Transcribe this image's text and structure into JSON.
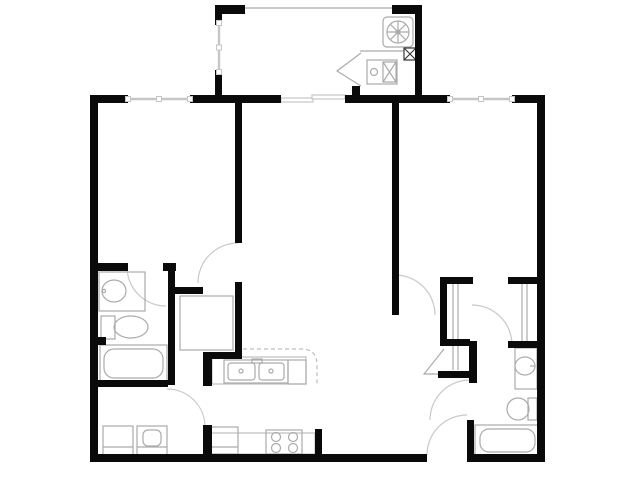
{
  "plan": {
    "canvas": {
      "width": 640,
      "height": 480,
      "background": "#ffffff"
    },
    "colors": {
      "wall": "#0a0a0a",
      "fixture": "#ababab",
      "counter": "#bdbdbd",
      "door_arc": "#c9c9c9",
      "window": "#c6c6c6",
      "dark_detail": "#3a3a3a"
    },
    "walls": [
      {
        "name": "wall-exterior-left",
        "r": [
          90,
          95,
          8,
          367
        ]
      },
      {
        "name": "wall-top-bed1-left",
        "r": [
          90,
          95,
          38,
          8
        ]
      },
      {
        "name": "wall-top-mid",
        "r": [
          190,
          95,
          91,
          8
        ]
      },
      {
        "name": "wall-top-living-right",
        "r": [
          345,
          95,
          105,
          8
        ]
      },
      {
        "name": "wall-top-right-corner",
        "r": [
          512,
          95,
          33,
          8
        ]
      },
      {
        "name": "wall-exterior-right",
        "r": [
          537,
          95,
          8,
          367
        ]
      },
      {
        "name": "wall-bottom-left",
        "r": [
          90,
          454,
          337,
          8
        ]
      },
      {
        "name": "wall-bottom-right",
        "r": [
          467,
          454,
          78,
          8
        ]
      },
      {
        "name": "balcony-wall-top-left",
        "r": [
          215,
          5,
          30,
          9
        ]
      },
      {
        "name": "balcony-wall-left-upper",
        "r": [
          215,
          5,
          7,
          20
        ]
      },
      {
        "name": "balcony-wall-left-lower",
        "r": [
          215,
          70,
          7,
          26
        ]
      },
      {
        "name": "balcony-wall-top-right",
        "r": [
          392,
          5,
          30,
          9
        ]
      },
      {
        "name": "balcony-wall-right",
        "r": [
          415,
          5,
          7,
          91
        ]
      },
      {
        "name": "patio-door-jamb",
        "r": [
          352,
          86,
          8,
          9
        ]
      },
      {
        "name": "wall-bed1-living",
        "r": [
          235,
          103,
          7,
          140
        ]
      },
      {
        "name": "wall-bath1-top",
        "r": [
          98,
          263,
          30,
          8
        ]
      },
      {
        "name": "wall-bath1-door-stub",
        "r": [
          163,
          263,
          13,
          8
        ]
      },
      {
        "name": "wall-bath1-right",
        "r": [
          168,
          265,
          7,
          120
        ]
      },
      {
        "name": "wall-laundry-top",
        "r": [
          98,
          380,
          70,
          7
        ]
      },
      {
        "name": "wall-bath1-plumbing-stub",
        "r": [
          98,
          337,
          8,
          8
        ]
      },
      {
        "name": "wall-closet1-top",
        "r": [
          175,
          287,
          28,
          7
        ]
      },
      {
        "name": "wall-closet1-right",
        "r": [
          235,
          282,
          7,
          77
        ]
      },
      {
        "name": "wall-closet1-bottom",
        "r": [
          205,
          352,
          37,
          7
        ]
      },
      {
        "name": "wall-kitchen-stub-upper",
        "r": [
          203,
          352,
          9,
          34
        ]
      },
      {
        "name": "wall-kitchen-stub-lower",
        "r": [
          203,
          425,
          9,
          30
        ]
      },
      {
        "name": "wall-kitchen-stub-right",
        "r": [
          315,
          429,
          7,
          26
        ]
      },
      {
        "name": "wall-living-bed2",
        "r": [
          392,
          103,
          7,
          212
        ]
      },
      {
        "name": "wall-closet2-left",
        "r": [
          440,
          277,
          7,
          69
        ]
      },
      {
        "name": "wall-closet2-top",
        "r": [
          440,
          277,
          33,
          7
        ]
      },
      {
        "name": "wall-closet3-top",
        "r": [
          508,
          277,
          30,
          7
        ]
      },
      {
        "name": "wall-closet2-bottom",
        "r": [
          440,
          339,
          30,
          7
        ]
      },
      {
        "name": "wall-closet3-bottom",
        "r": [
          508,
          341,
          32,
          7
        ]
      },
      {
        "name": "wall-linen-right",
        "r": [
          469,
          341,
          8,
          42
        ]
      },
      {
        "name": "wall-linen-bottom",
        "r": [
          438,
          371,
          39,
          7
        ]
      },
      {
        "name": "wall-bath2-left",
        "r": [
          467,
          420,
          7,
          38
        ]
      }
    ],
    "windows": [
      {
        "name": "bed1-window",
        "o": "h",
        "p": [
          128,
          99,
          62
        ]
      },
      {
        "name": "bed2-window",
        "o": "h",
        "p": [
          450,
          99,
          62
        ]
      },
      {
        "name": "balcony-side-window",
        "o": "v",
        "p": [
          219,
          23,
          49
        ]
      }
    ],
    "sliding_door_panels": [
      {
        "name": "patio-door-panel-left",
        "r": [
          281,
          98,
          32,
          4
        ]
      },
      {
        "name": "patio-door-panel-right",
        "r": [
          312,
          95,
          33,
          4
        ]
      }
    ],
    "doors": [
      {
        "name": "bed1-door-swing",
        "cx": 238,
        "cy": 283,
        "rad": 40,
        "a1": -90,
        "a2": -180
      },
      {
        "name": "bath1-door-swing",
        "cx": 166,
        "cy": 267,
        "rad": 39,
        "a1": 180,
        "a2": 90
      },
      {
        "name": "laundry-door-swing",
        "cx": 167,
        "cy": 427,
        "rad": 38,
        "a1": -90,
        "a2": 0
      },
      {
        "name": "bed2-door-swing",
        "cx": 395,
        "cy": 315,
        "rad": 40,
        "a1": -90,
        "a2": 0
      },
      {
        "name": "bath2-hall-door-swing",
        "cx": 472,
        "cy": 345,
        "rad": 40,
        "a1": -90,
        "a2": 0
      },
      {
        "name": "bath2-door-swing",
        "cx": 470,
        "cy": 420,
        "rad": 40,
        "a1": -90,
        "a2": -180
      },
      {
        "name": "entry-door-swing",
        "cx": 467,
        "cy": 455,
        "rad": 40,
        "a1": 180,
        "a2": 270
      }
    ],
    "fixtures": [
      {
        "name": "balcony-screen-line",
        "type": "line",
        "p": [
          243,
          8,
          392,
          8
        ]
      },
      {
        "name": "ac-unit-body",
        "type": "rect",
        "r": [
          383,
          17,
          30,
          30
        ],
        "rx": 4
      },
      {
        "name": "ac-fan-ring",
        "type": "circle",
        "c": [
          398,
          32
        ],
        "rad": 11
      },
      {
        "name": "ac-fan-blades",
        "type": "spokes",
        "c": [
          398,
          32
        ],
        "rad": 11,
        "n": 8
      },
      {
        "name": "ac-fan-hub",
        "type": "circle",
        "c": [
          398,
          32
        ],
        "rad": 2
      },
      {
        "name": "utility-shelf-line",
        "type": "line",
        "p": [
          360,
          51,
          404,
          51
        ]
      },
      {
        "name": "utility-vent-box",
        "type": "xbox",
        "r": [
          404,
          48,
          12,
          12
        ],
        "c2": "dark_detail"
      },
      {
        "name": "water-heater-body",
        "type": "rect",
        "r": [
          367,
          60,
          30,
          24
        ]
      },
      {
        "name": "water-heater-knob",
        "type": "circle",
        "c": [
          374,
          72
        ],
        "rad": 3.5
      },
      {
        "name": "water-heater-panel",
        "type": "xbox",
        "r": [
          383,
          62,
          13,
          20
        ]
      },
      {
        "name": "utility-door-leaf",
        "type": "polyline",
        "pts": "361,53 337,71 361,86"
      },
      {
        "name": "bath1-vanity",
        "type": "rect",
        "r": [
          99,
          272,
          46,
          39
        ]
      },
      {
        "name": "bath1-sink",
        "type": "ellipse",
        "c": [
          114,
          291
        ],
        "rr": [
          12,
          11
        ]
      },
      {
        "name": "bath1-faucet-dot",
        "type": "circle",
        "c": [
          104,
          291
        ],
        "rad": 1.6
      },
      {
        "name": "bath1-toilet-tank",
        "type": "rect",
        "r": [
          101,
          316,
          14,
          23
        ]
      },
      {
        "name": "bath1-toilet-bowl",
        "type": "ellipse",
        "c": [
          131,
          327
        ],
        "rr": [
          17,
          11
        ]
      },
      {
        "name": "bath1-tub",
        "type": "rect",
        "r": [
          100,
          345,
          67,
          37
        ]
      },
      {
        "name": "bath1-tub-basin",
        "type": "rect",
        "r": [
          104,
          349,
          59,
          29
        ],
        "rx": 10
      },
      {
        "name": "washer",
        "type": "rect",
        "r": [
          103,
          426,
          30,
          29
        ]
      },
      {
        "name": "washer-lid-line",
        "type": "line",
        "p": [
          103,
          447,
          133,
          447
        ]
      },
      {
        "name": "dryer",
        "type": "rect",
        "r": [
          137,
          426,
          30,
          29
        ]
      },
      {
        "name": "dryer-door",
        "type": "rect",
        "r": [
          143,
          430,
          18,
          16
        ],
        "rx": 5
      },
      {
        "name": "dryer-lid-line",
        "type": "line",
        "p": [
          137,
          447,
          167,
          447
        ]
      },
      {
        "name": "bed1-closet-shelf",
        "type": "rect",
        "r": [
          180,
          296,
          53,
          54
        ]
      },
      {
        "name": "kitchen-peninsula-counter",
        "type": "rect",
        "r": [
          212,
          357,
          94,
          27
        ],
        "c2": "counter"
      },
      {
        "name": "kitchen-counter-overhang",
        "type": "path",
        "d": "M 243,349 L 301,349 Q 317,349 317,365 L 317,384",
        "dashed": true,
        "c2": "counter"
      },
      {
        "name": "kitchen-sink-unit",
        "type": "rect",
        "r": [
          224,
          360,
          64,
          23
        ]
      },
      {
        "name": "kitchen-sink-basin-left",
        "type": "rect",
        "r": [
          228,
          363,
          27,
          17
        ],
        "rx": 3
      },
      {
        "name": "kitchen-sink-basin-right",
        "type": "rect",
        "r": [
          259,
          363,
          25,
          17
        ],
        "rx": 3
      },
      {
        "name": "kitchen-faucet",
        "type": "rect",
        "r": [
          252,
          359,
          10,
          4
        ]
      },
      {
        "name": "sink-drain-left",
        "type": "circle",
        "c": [
          241,
          371
        ],
        "rad": 2
      },
      {
        "name": "sink-drain-right",
        "type": "circle",
        "c": [
          271,
          371
        ],
        "rad": 2
      },
      {
        "name": "dishwasher",
        "type": "rect",
        "r": [
          288,
          360,
          18,
          24
        ]
      },
      {
        "name": "kitchen-base-counter",
        "type": "rect",
        "r": [
          210,
          433,
          105,
          21
        ],
        "c2": "counter"
      },
      {
        "name": "fridge",
        "type": "rect",
        "r": [
          211,
          427,
          27,
          27
        ]
      },
      {
        "name": "fridge-door-line",
        "type": "line",
        "p": [
          211,
          447,
          238,
          447
        ]
      },
      {
        "name": "range",
        "type": "rect",
        "r": [
          266,
          430,
          36,
          24
        ]
      },
      {
        "name": "burner-left-front",
        "type": "circle",
        "c": [
          276,
          448
        ],
        "rad": 4.5
      },
      {
        "name": "burner-left-back",
        "type": "circle",
        "c": [
          276,
          437
        ],
        "rad": 4.5
      },
      {
        "name": "burner-right-front",
        "type": "circle",
        "c": [
          293,
          448
        ],
        "rad": 4.5
      },
      {
        "name": "burner-right-back",
        "type": "circle",
        "c": [
          293,
          437
        ],
        "rad": 4.5
      },
      {
        "name": "bed2-closet-door-line-1",
        "type": "line",
        "p": [
          453,
          284,
          453,
          370
        ]
      },
      {
        "name": "bed2-closet-door-line-2",
        "type": "line",
        "p": [
          458,
          284,
          458,
          370
        ]
      },
      {
        "name": "bed2-closet2-door-line-1",
        "type": "line",
        "p": [
          522,
          284,
          522,
          341
        ]
      },
      {
        "name": "bed2-closet2-door-line-2",
        "type": "line",
        "p": [
          527,
          284,
          527,
          341
        ]
      },
      {
        "name": "linen-closet-door-leaf",
        "type": "polyline",
        "pts": "444,349 424,374 446,374"
      },
      {
        "name": "bath2-vanity",
        "type": "rect",
        "r": [
          515,
          348,
          22,
          41
        ]
      },
      {
        "name": "bath2-sink",
        "type": "ellipse",
        "c": [
          525,
          366
        ],
        "rr": [
          10,
          9
        ]
      },
      {
        "name": "bath2-faucet-line",
        "type": "line",
        "p": [
          530,
          366,
          535,
          366
        ]
      },
      {
        "name": "bath2-toilet-bowl",
        "type": "ellipse",
        "c": [
          518,
          409
        ],
        "rr": [
          11,
          11
        ]
      },
      {
        "name": "bath2-toilet-tank",
        "type": "rect",
        "r": [
          528,
          398,
          9,
          22
        ]
      },
      {
        "name": "bath2-tub",
        "type": "rect",
        "r": [
          475,
          425,
          65,
          31
        ]
      },
      {
        "name": "bath2-tub-basin",
        "type": "rect",
        "r": [
          480,
          429,
          55,
          23
        ],
        "rx": 9
      }
    ]
  }
}
